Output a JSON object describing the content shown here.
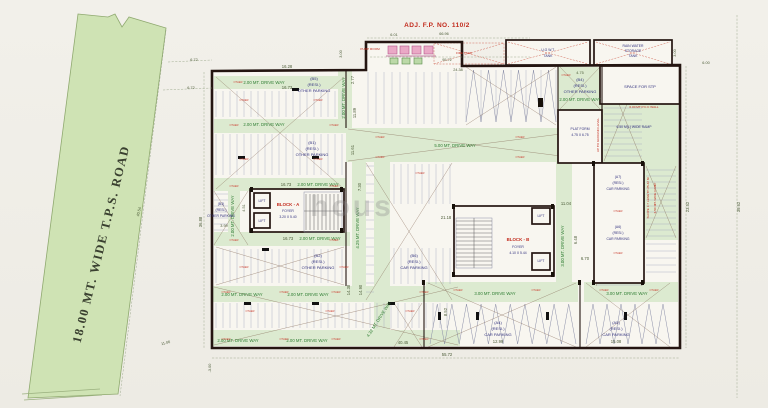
{
  "site": {
    "adj_plot_label": "ADJ. F.P. NO. 110/2",
    "road_label": "18.00 MT. WIDE T.P.S. ROAD",
    "watermark": "hous"
  },
  "facilities": {
    "pump_room": "PUMP ROOM",
    "fire_tank": "FIRE TANK",
    "ugwt_line1": "U.G W.T.",
    "ugwt_line2": "TANK",
    "rain_line1": "RAIN WATER",
    "rain_line2": "STORAGE",
    "rain_line3": "TANK",
    "stp": "SPACE FOR STP",
    "platform_line1": "PLAT FORM",
    "platform_line2": "4.75 X 6.75",
    "ramp_label": "6.50 M(L) WIDE RAMP",
    "ramp_up": "UP TO GROUND LEVEL",
    "ramp_slope": "SLOPE 1:7 LENGTH 25.42 M",
    "ramp_width": "6.50 MT. WIDE RAMP",
    "pcc_wall": "6.00 MT P.C.C WALL"
  },
  "blocks": {
    "a_title": "BLOCK - A",
    "a_foyer": "FOYER",
    "a_size": "3.20 X 5.40",
    "b_title": "BLOCK - B",
    "b_foyer": "FOYER",
    "b_size": "4.10 X 5.44",
    "lift": "LIFT"
  },
  "driveways": {
    "dw200": "2.00 MT. DRIVE WAY",
    "dw300": "3.00 MT. DRIVE WAY",
    "dw425": "4.25 MT. DRIVE WAY",
    "dw432": "4.32 MT. DRIVE WAY",
    "dw500": "5.00 MT. DRIVE WAY"
  },
  "parking": {
    "resi": "(RESI.)",
    "other": "OTHER PARKING",
    "car": "CAR PARKING",
    "b1": "(B1)",
    "b2": "(B2)",
    "b3": "(B3)",
    "b4": "(B4)",
    "b5": "(B5)",
    "b6": "(B6)",
    "a4": "(A4)",
    "a5": "(A5)",
    "a6": "(A6)",
    "a7": "(A7)",
    "stall_tag": "OTHER"
  },
  "dims": {
    "d16_28": "16.28",
    "d16_73": "16.73",
    "d2_77": "2.77",
    "d11_89": "11.89",
    "d11_61": "11.61",
    "d7_30": "7.30",
    "d21_18": "21.18",
    "d11_04": "11.04",
    "d6_48": "6.48",
    "d14_38": "14.38",
    "d14_90": "14.90",
    "d12_99": "12.99",
    "d15_08": "15.08",
    "d40_45": "40.45",
    "d55_72": "55.72",
    "d23_52": "23.52",
    "d39_62": "39.62",
    "d36_88": "36.88",
    "d40_54": "40.54",
    "d6_72": "6.72",
    "d6_01": "6.01",
    "d66_96": "66.96",
    "d95_72": "95.72",
    "d24_38": "24.38",
    "d3_00": "3.00",
    "d4_75": "4.75",
    "d6_00": "6.00",
    "d8_52": "8.52",
    "d3_99": "3.99",
    "d4_51": "4.51",
    "d6_70": "6.70",
    "dm3_00": "-3.00",
    "d11_06": "11.06"
  },
  "colors": {
    "road_green": "#cfe3b4",
    "band_green": "#dcead0",
    "wall": "#241511",
    "dim_text": "#4c5c38",
    "drive_text": "#2e7d32",
    "parking_text": "#31317e",
    "red_text": "#c22a1c",
    "paper": "#f0eee9"
  }
}
